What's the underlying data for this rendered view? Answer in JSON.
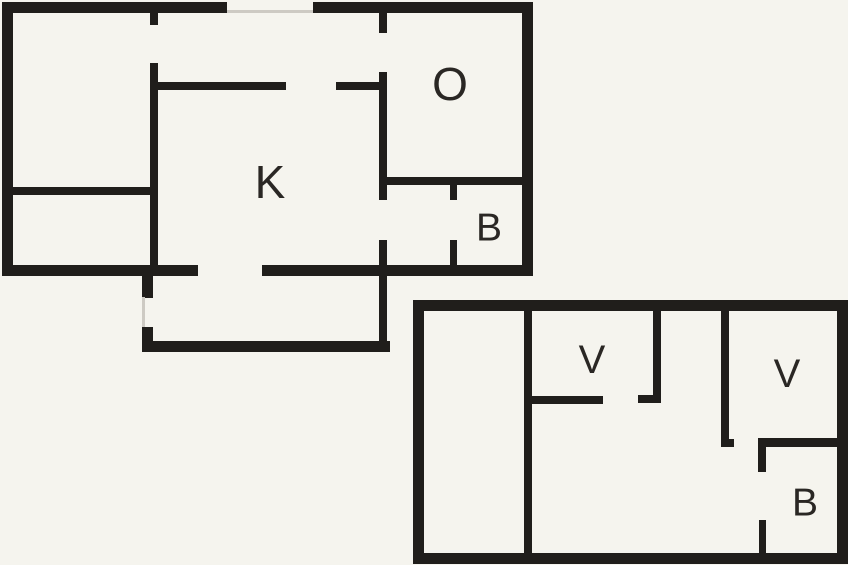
{
  "colors": {
    "background": "#f5f4ee",
    "wall": "#201e1b",
    "window": "#cdcac3",
    "label": "#2a2724"
  },
  "plans": [
    {
      "name": "upper-floor-plan",
      "labels": [
        {
          "text": "O",
          "x": 450,
          "y": 84,
          "size": 46
        },
        {
          "text": "K",
          "x": 270,
          "y": 182,
          "size": 46
        },
        {
          "text": "B",
          "x": 489,
          "y": 228,
          "size": 39
        }
      ],
      "walls": [
        [
          2,
          2,
          225,
          11
        ],
        [
          313,
          2,
          220,
          11
        ],
        [
          2,
          2,
          11,
          274
        ],
        [
          522,
          2,
          11,
          274
        ],
        [
          2,
          265,
          196,
          11
        ],
        [
          262,
          265,
          271,
          11
        ],
        [
          142,
          276,
          11,
          22
        ],
        [
          142,
          327,
          11,
          25
        ],
        [
          142,
          341,
          248,
          11
        ],
        [
          379,
          240,
          8,
          112
        ],
        [
          150,
          13,
          8,
          12
        ],
        [
          150,
          63,
          8,
          202
        ],
        [
          2,
          187,
          156,
          8
        ],
        [
          150,
          82,
          136,
          8
        ],
        [
          336,
          82,
          51,
          8
        ],
        [
          379,
          13,
          8,
          20
        ],
        [
          379,
          72,
          8,
          128
        ],
        [
          379,
          177,
          154,
          8
        ],
        [
          450,
          184,
          7,
          16
        ],
        [
          450,
          240,
          7,
          25
        ]
      ],
      "windows": [
        [
          227,
          10,
          86,
          3
        ],
        [
          142,
          297,
          3,
          30
        ]
      ]
    },
    {
      "name": "lower-floor-plan",
      "labels": [
        {
          "text": "V",
          "x": 592,
          "y": 360,
          "size": 40
        },
        {
          "text": "V",
          "x": 787,
          "y": 374,
          "size": 40
        },
        {
          "text": "B",
          "x": 805,
          "y": 503,
          "size": 39
        }
      ],
      "walls": [
        [
          413,
          300,
          435,
          11
        ],
        [
          413,
          300,
          11,
          264
        ],
        [
          837,
          300,
          11,
          264
        ],
        [
          413,
          553,
          435,
          11
        ],
        [
          524,
          311,
          8,
          242
        ],
        [
          532,
          396,
          71,
          8
        ],
        [
          638,
          395,
          23,
          8
        ],
        [
          653,
          311,
          8,
          92
        ],
        [
          721,
          311,
          8,
          136
        ],
        [
          729,
          439,
          5,
          8
        ],
        [
          758,
          438,
          84,
          9
        ],
        [
          758,
          447,
          8,
          25
        ],
        [
          759,
          520,
          7,
          33
        ]
      ],
      "windows": []
    }
  ]
}
